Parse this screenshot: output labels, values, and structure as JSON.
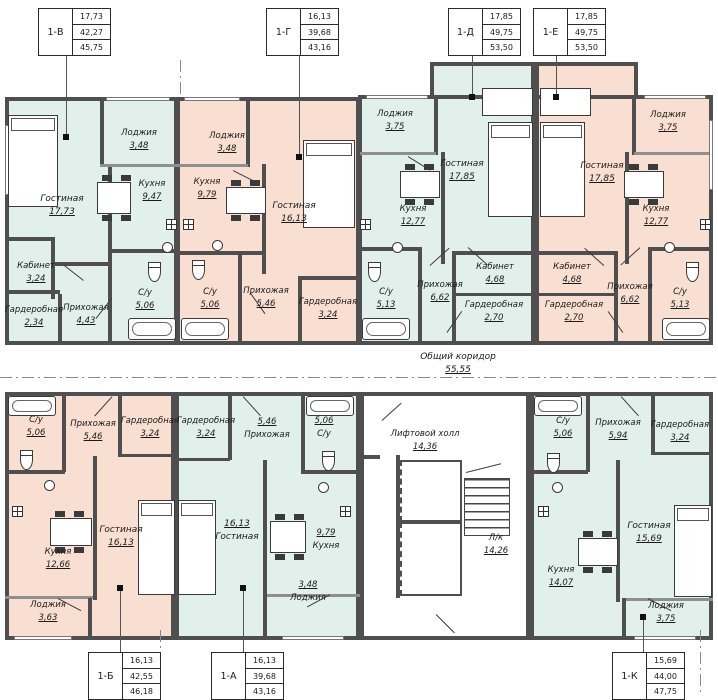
{
  "colors": {
    "unit_teal": "#e1f0ea",
    "unit_pink": "#f9ded2",
    "wall": "#4f4f4f"
  },
  "common": {
    "corridor": {
      "name": "Общий коридор",
      "area": "55,55"
    },
    "elevator_hall": {
      "name": "Лифтовой холл",
      "area": "14,36"
    },
    "stairwell": {
      "name": "Л/к",
      "area": "14,26"
    }
  },
  "apartments": {
    "v": {
      "id": "1-В",
      "stats": [
        "17,73",
        "42,27",
        "45,75"
      ],
      "rooms": {
        "living": {
          "name": "Гостиная",
          "area": "17,73"
        },
        "loggia": {
          "name": "Лоджия",
          "area": "3,48"
        },
        "kitchen": {
          "name": "Кухня",
          "area": "9,47"
        },
        "cabinet": {
          "name": "Кабинет",
          "area": "3,24"
        },
        "wardrobe": {
          "name": "Гардеробная",
          "area": "2,34"
        },
        "hall": {
          "name": "Прихожая",
          "area": "4,43"
        },
        "bath": {
          "name": "С/у",
          "area": "5,06"
        }
      }
    },
    "g": {
      "id": "1-Г",
      "stats": [
        "16,13",
        "39,68",
        "43,16"
      ],
      "rooms": {
        "loggia": {
          "name": "Лоджия",
          "area": "3,48"
        },
        "kitchen": {
          "name": "Кухня",
          "area": "9,79"
        },
        "living": {
          "name": "Гостиная",
          "area": "16,13"
        },
        "bath": {
          "name": "С/у",
          "area": "5,06"
        },
        "hall": {
          "name": "Прихожая",
          "area": "5,46"
        },
        "wardrobe": {
          "name": "Гардеробная",
          "area": "3,24"
        }
      }
    },
    "d": {
      "id": "1-Д",
      "stats": [
        "17,85",
        "49,75",
        "53,50"
      ],
      "rooms": {
        "loggia": {
          "name": "Лоджия",
          "area": "3,75"
        },
        "living": {
          "name": "Гостиная",
          "area": "17,85"
        },
        "kitchen": {
          "name": "Кухня",
          "area": "12,77"
        },
        "bath": {
          "name": "С/у",
          "area": "5,13"
        },
        "hall": {
          "name": "Прихожая",
          "area": "6,62"
        },
        "cabinet": {
          "name": "Кабинет",
          "area": "4,68"
        },
        "wardrobe": {
          "name": "Гардеробная",
          "area": "2,70"
        }
      }
    },
    "e": {
      "id": "1-Е",
      "stats": [
        "17,85",
        "49,75",
        "53,50"
      ],
      "rooms": {
        "loggia": {
          "name": "Лоджия",
          "area": "3,75"
        },
        "living": {
          "name": "Гостиная",
          "area": "17,85"
        },
        "kitchen": {
          "name": "Кухня",
          "area": "12,77"
        },
        "cabinet": {
          "name": "Кабинет",
          "area": "4,68"
        },
        "wardrobe": {
          "name": "Гардеробная",
          "area": "2,70"
        },
        "hall": {
          "name": "Прихожая",
          "area": "6,62"
        },
        "bath": {
          "name": "С/у",
          "area": "5,13"
        }
      }
    },
    "b": {
      "id": "1-Б",
      "stats": [
        "16,13",
        "42,55",
        "46,18"
      ],
      "rooms": {
        "bath": {
          "name": "С/у",
          "area": "5,06"
        },
        "hall": {
          "name": "Прихожая",
          "area": "5,46"
        },
        "wardrobe": {
          "name": "Гардеробная",
          "area": "3,24"
        },
        "kitchen": {
          "name": "Кухня",
          "area": "12,66"
        },
        "living": {
          "name": "Гостиная",
          "area": "16,13"
        },
        "loggia": {
          "name": "Лоджия",
          "area": "3,63"
        }
      }
    },
    "a": {
      "id": "1-А",
      "stats": [
        "16,13",
        "39,68",
        "43,16"
      ],
      "rooms": {
        "wardrobe": {
          "name": "Гардеробная",
          "area": "3,24"
        },
        "hall": {
          "name": "Прихожая",
          "area": "5,46"
        },
        "bath": {
          "name": "С/у",
          "area": "5,06"
        },
        "living": {
          "name": "Гостиная",
          "area": "16,13"
        },
        "kitchen": {
          "name": "Кухня",
          "area": "9,79"
        },
        "loggia": {
          "name": "Лоджия",
          "area": "3,48"
        }
      }
    },
    "k": {
      "id": "1-К",
      "stats": [
        "15,69",
        "44,00",
        "47,75"
      ],
      "rooms": {
        "bath": {
          "name": "С/у",
          "area": "5,06"
        },
        "hall": {
          "name": "Прихожая",
          "area": "5,94"
        },
        "wardrobe": {
          "name": "Гардеробная",
          "area": "3,24"
        },
        "kitchen": {
          "name": "Кухня",
          "area": "14,07"
        },
        "living": {
          "name": "Гостиная",
          "area": "15,69"
        },
        "loggia": {
          "name": "Лоджия",
          "area": "3,75"
        }
      }
    }
  }
}
